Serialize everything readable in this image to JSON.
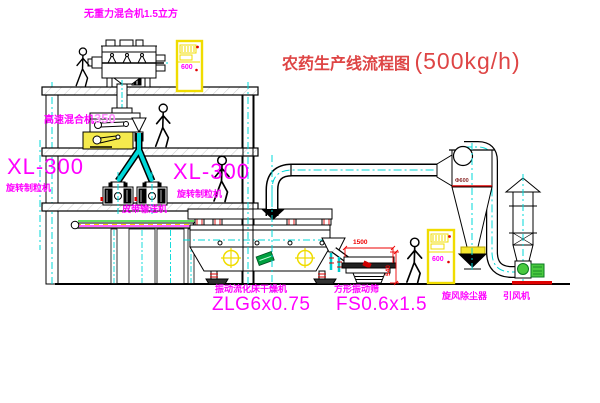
{
  "title": {
    "name": "农药生产线流程图",
    "capacity": "(500kg/h)"
  },
  "labels": {
    "gravity_mixer": "无重力混合机1.5立方",
    "high_speed_mixer": "高速混合机",
    "high_speed_mixer_size": "350",
    "granulator_left_model": "XL-300",
    "granulator_left_name": "旋转制粒机",
    "granulator_right_model": "XL-300",
    "granulator_right_name": "旋转制粒机",
    "belt_conveyor": "皮带输送机",
    "dryer_name": "振动流化床干燥机",
    "dryer_model": "ZLG6x0.75",
    "screen_name": "方形振动筛",
    "screen_model": "FS0.6x1.5",
    "cyclone_name": "旋风除尘器",
    "fan_name": "引风机"
  },
  "dimensions": {
    "screen_length": "1500",
    "screen_height": "540",
    "cyclone_diameter": "Φ600"
  },
  "cabinets": {
    "top_cabinet_text": "600",
    "right_cabinet_text": "600"
  },
  "colors": {
    "label_magenta": "#ff00ff",
    "title_red": "#de4545",
    "dimension_red": "#ee0000",
    "centerline_cyan": "#00d8d8",
    "cabinet_yellow": "#f0dc00",
    "fan_green": "#49c93f"
  }
}
